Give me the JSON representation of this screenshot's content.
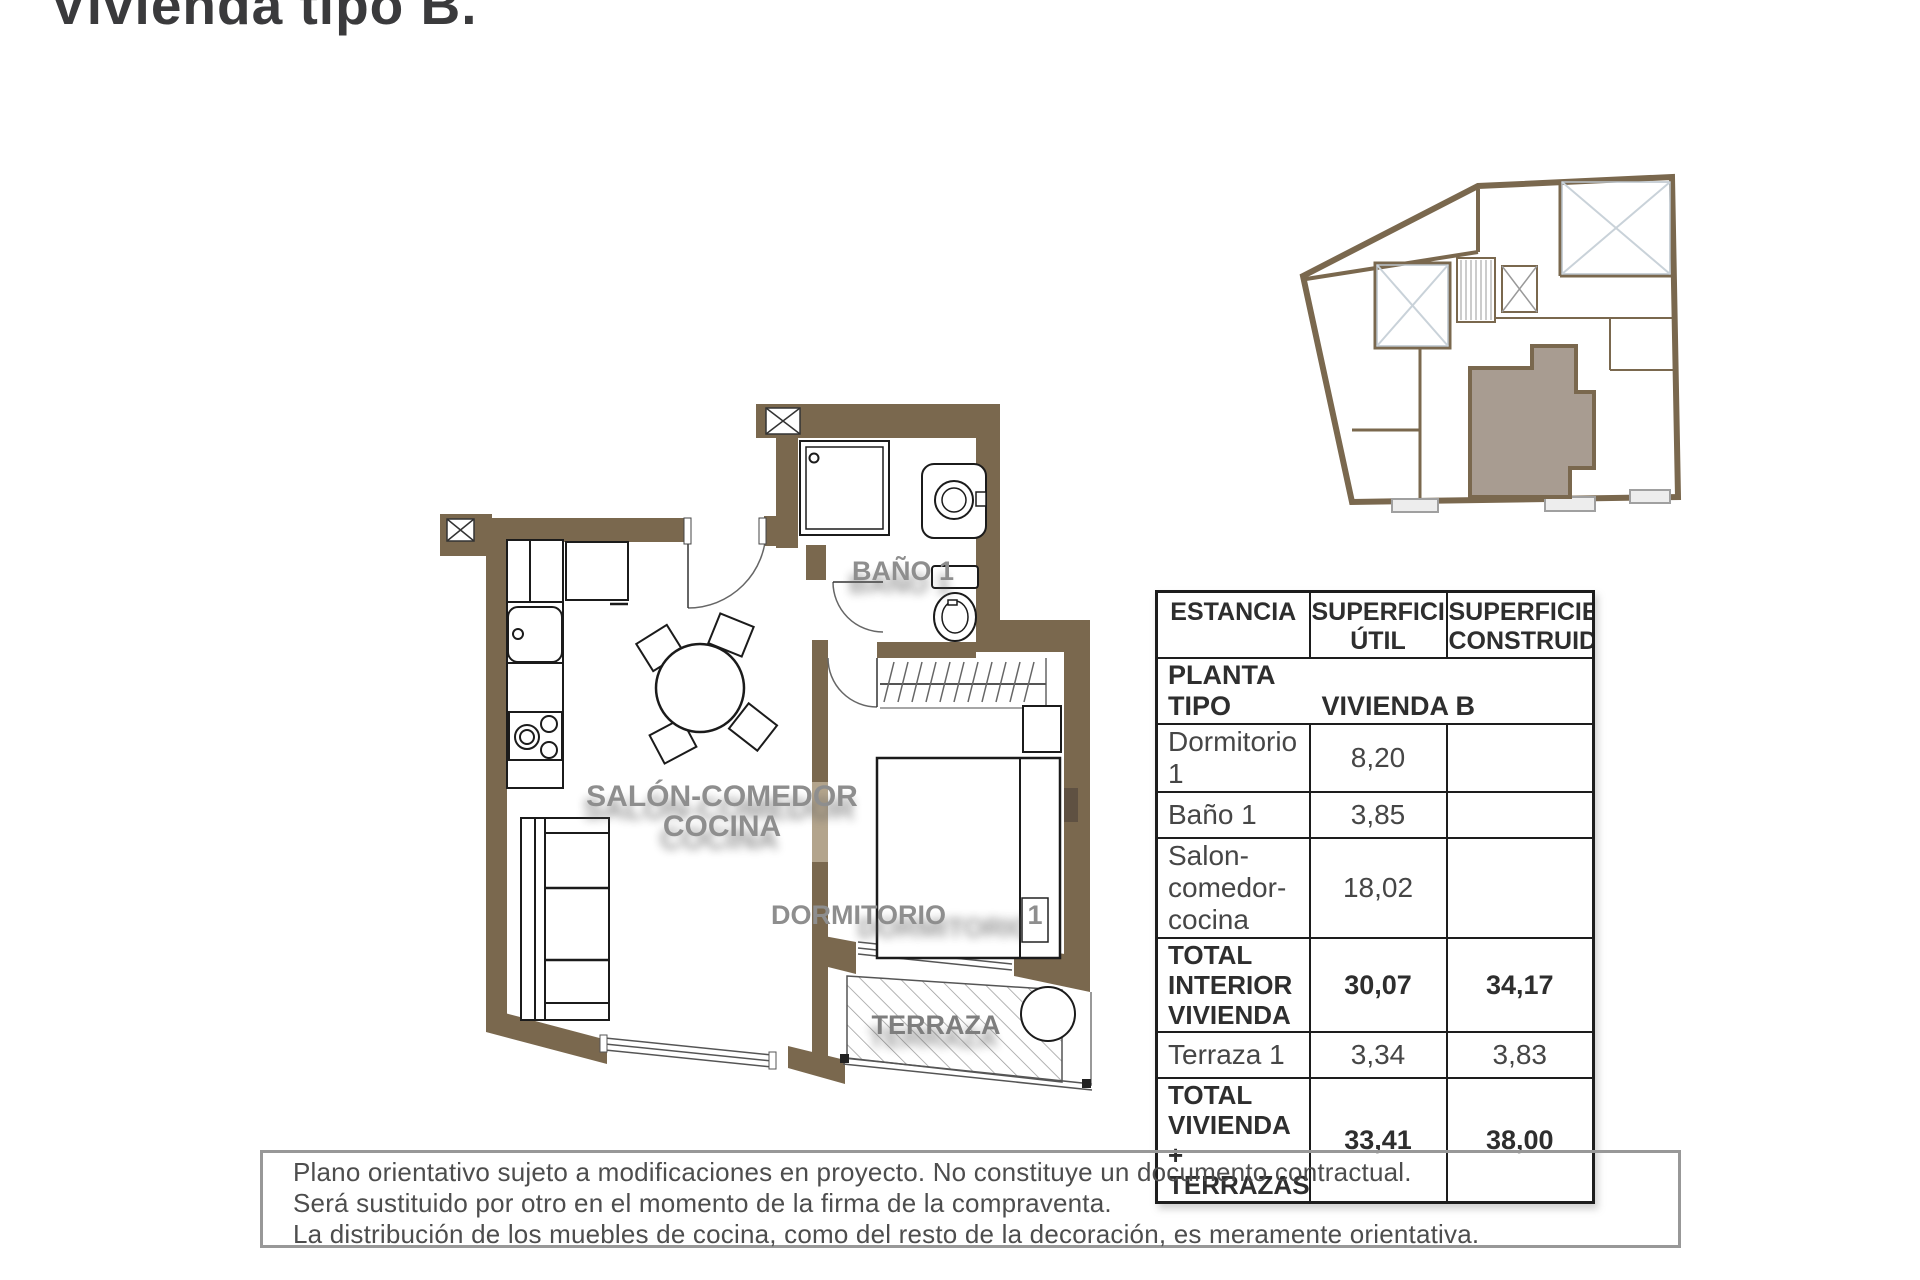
{
  "page": {
    "title": "Vivienda tipo B."
  },
  "plan": {
    "labels": {
      "salon_line1": "SALÓN-COMEDOR",
      "salon_line2": "COCINA",
      "bano": "BAÑO 1",
      "dormitorio": "DORMITORIO",
      "dormitorio_num": "1",
      "terraza": "TERRAZA"
    }
  },
  "table": {
    "header": {
      "col1": "ESTANCIA",
      "col2_line1": "SUPERFICIE",
      "col2_line2": "ÚTIL",
      "col3_line1": "SUPERFICIE",
      "col3_line2": "CONSTRUIDA"
    },
    "subheader": {
      "left": "PLANTA TIPO",
      "right": "VIVIENDA B"
    },
    "rows": [
      {
        "name": "Dormitorio 1",
        "util": "8,20",
        "construida": ""
      },
      {
        "name": "Baño 1",
        "util": "3,85",
        "construida": ""
      },
      {
        "name": "Salon-comedor-cocina",
        "util": "18,02",
        "construida": ""
      },
      {
        "name": "TOTAL INTERIOR VIVIENDA",
        "util": "30,07",
        "construida": "34,17"
      },
      {
        "name": "Terraza 1",
        "util": "3,34",
        "construida": "3,83"
      },
      {
        "name": "TOTAL VIVIENDA + TERRAZAS",
        "util": "33,41",
        "construida": "38,00"
      }
    ]
  },
  "disclaimer": {
    "line1": "Plano orientativo sujeto a modificaciones en proyecto. No constituye un documento contractual.",
    "line2": "Será sustituido por otro en el momento de la firma de la compraventa.",
    "line3": "La distribución de los muebles de cocina, como del resto de la decoración, es meramente orientativa."
  },
  "colors": {
    "wall_brown": "#7a684e",
    "partition_tan": "#b3a48c",
    "label_gray": "#8e8e8e",
    "title_gray": "#3a3a3c",
    "highlight_unit": "#a89c91",
    "patio_lines": "#c9d2d9",
    "disclaimer_border": "#989898"
  }
}
